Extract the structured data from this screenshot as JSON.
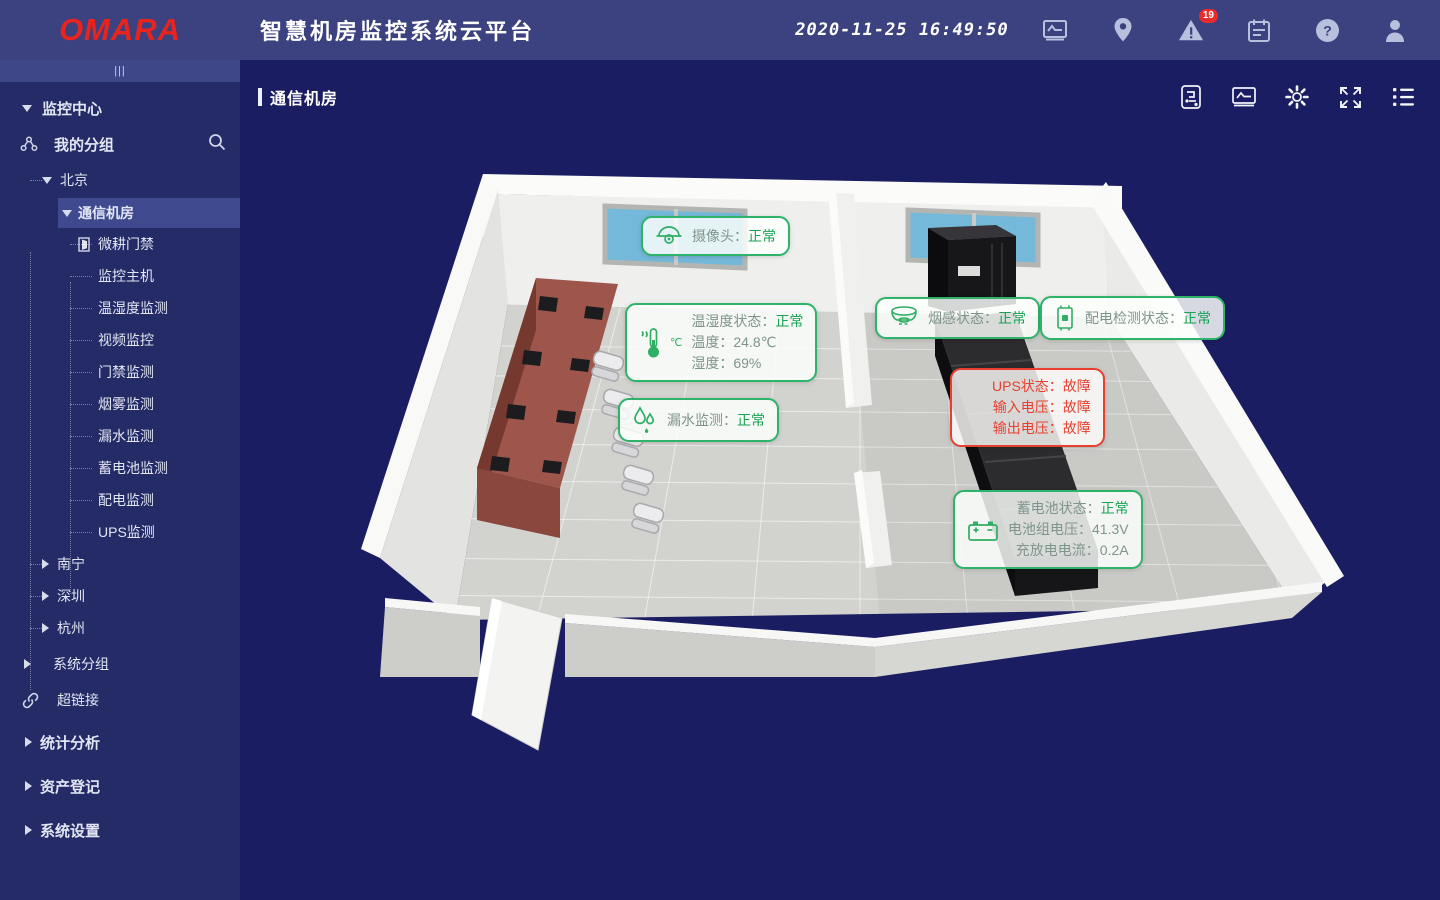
{
  "header": {
    "logo": "OMARA",
    "title": "智慧机房监控系统云平台",
    "clock": "2020-11-25 16:49:50",
    "alert_badge": "19",
    "icons": [
      "monitor-chart-icon",
      "location-pin-icon",
      "alert-triangle-icon",
      "calendar-icon",
      "help-icon",
      "user-icon"
    ]
  },
  "sidebar": {
    "collapse_handle": "|||",
    "root": "监控中心",
    "my_group": "我的分组",
    "city_beijing": "北京",
    "room": "通信机房",
    "devices": [
      "微耕门禁",
      "监控主机",
      "温湿度监测",
      "视频监控",
      "门禁监测",
      "烟雾监测",
      "漏水监测",
      "蓄电池监测",
      "配电监测",
      "UPS监测"
    ],
    "city_nanning": "南宁",
    "city_shenzhen": "深圳",
    "city_hangzhou": "杭州",
    "system_group": "系统分组",
    "hyperlink": "超链接",
    "stats": "统计分析",
    "assets": "资产登记",
    "settings": "系统设置"
  },
  "main": {
    "breadcrumb": "通信机房",
    "toolbar_icons": [
      "report-icon",
      "screen-icon",
      "gear-icon",
      "fullscreen-icon",
      "list-icon"
    ],
    "overlays": {
      "camera": {
        "label": "摄像头：",
        "value": "正常"
      },
      "temp": {
        "unit": "℃",
        "l1": "温湿度状态：",
        "v1": "正常",
        "l2": "温度：",
        "v2": "24.8℃",
        "l3": "湿度：",
        "v3": "69%"
      },
      "water": {
        "label": "漏水监测：",
        "value": "正常"
      },
      "smoke": {
        "label": "烟感状态：",
        "value": "正常"
      },
      "power": {
        "label": "配电检测状态：",
        "value": "正常"
      },
      "ups": {
        "l1": "UPS状态：",
        "v1": "故障",
        "l2": "输入电压：",
        "v2": "故障",
        "l3": "输出电压：",
        "v3": "故障"
      },
      "battery": {
        "l1": "蓄电池状态：",
        "v1": "正常",
        "l2": "电池组电压：",
        "v2": "41.3V",
        "l3": "充放电电流：",
        "v3": "0.2A"
      }
    }
  },
  "colors": {
    "header_bg": "#3c4180",
    "sidebar_bg": "#252b66",
    "main_bg": "#1a1d61",
    "brand_red": "#e8241c",
    "ok_green": "#17a254",
    "fault_red": "#e8402f",
    "selected_bg": "#3f4a8e"
  }
}
